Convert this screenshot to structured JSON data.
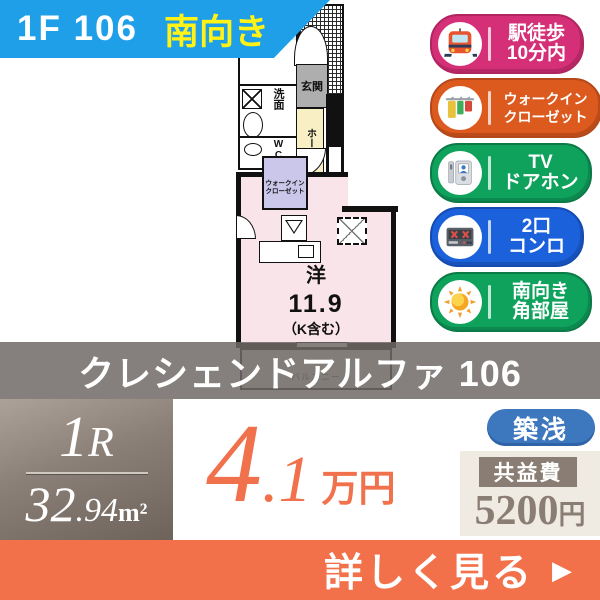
{
  "header": {
    "floor_unit": "1F 106",
    "direction": "南向き"
  },
  "badges": [
    {
      "icon": "train-icon",
      "line1": "駅徒歩",
      "line2": "10分内",
      "color": "#D53077"
    },
    {
      "icon": "closet-icon",
      "line1": "ウォークイン",
      "line2": "クローゼット",
      "color": "#DC5A1E"
    },
    {
      "icon": "doorphone-icon",
      "line1": "TV",
      "line2": "ドアホン",
      "color": "#0FA25C"
    },
    {
      "icon": "stove-icon",
      "line1": "2口",
      "line2": "コンロ",
      "color": "#1B61DB"
    },
    {
      "icon": "sun-icon",
      "line1": "南向き",
      "line2": "角部屋",
      "color": "#0FA25C"
    }
  ],
  "floorplan": {
    "bath": "浴室",
    "wash": "洗面",
    "wc": "WC",
    "entrance": "玄関",
    "hall": "ホール",
    "closet_line1": "ウォークイン",
    "closet_line2": "クローゼット",
    "room_type": "洋",
    "room_size": "11.9",
    "room_note": "（K含む）",
    "balcony": "バルコニー"
  },
  "title": "クレシェンドアルファ 106",
  "summary": {
    "layout_big": "1",
    "layout_small": "R",
    "area_int": "32",
    "area_dec": ".94",
    "area_unit": "m²",
    "price_int": "4",
    "price_dec": ".1",
    "price_unit": "万円",
    "age_badge": "築浅",
    "fee_label": "共益費",
    "fee_value": "5200",
    "fee_unit": "円"
  },
  "footer": {
    "cta": "詳しく見る",
    "arrow": "▶"
  },
  "colors": {
    "header_bg": "#1E9FE8",
    "header_highlight": "#FFF216",
    "price": "#F0714B",
    "cta_bg": "#F2714A",
    "age_badge_bg": "#3D77BE",
    "fee_bg": "#8A7E74",
    "room_pink": "#F9E4EA",
    "hall_yellow": "#F9EFC5",
    "closet_purple": "#CAC7EB"
  }
}
